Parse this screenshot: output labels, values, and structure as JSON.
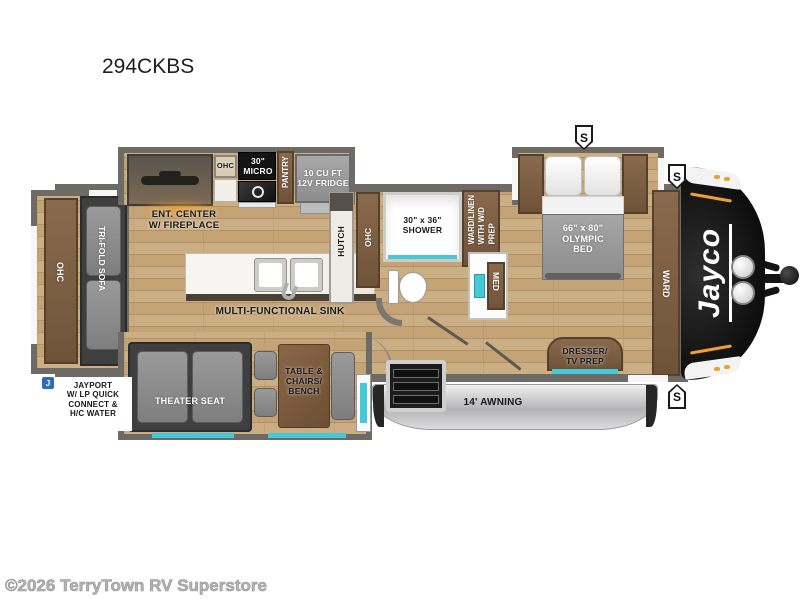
{
  "page": {
    "title": "294CKBS",
    "watermark": "©2026 TerryTown RV Superstore"
  },
  "brand": {
    "logo": "Jayco"
  },
  "icons": {
    "speaker": "S",
    "jayport": "J"
  },
  "rooms": {
    "rear_ohc": "OHC",
    "trifold_sofa": "TRI-FOLD SOFA",
    "ent_center": "ENT. CENTER\nW/ FIREPLACE",
    "kitchen_ohc": "OHC",
    "micro": "30\"\nMICRO",
    "pantry": "PANTRY",
    "fridge": "10 CU FT\n12V FRIDGE",
    "hutch": "HUTCH",
    "hutch_ohc": "OHC",
    "sink": "MULTI-FUNCTIONAL SINK",
    "shower": "30\" x 36\"\nSHOWER",
    "ward_linen": "WARD/LINEN\nWITH W/D\nPREP",
    "med": "MED",
    "bed": "66\" x 80\"\nOLYMPIC\nBED",
    "ward": "WARD",
    "dresser": "DRESSER/\nTV PREP",
    "theater_seat": "THEATER SEAT",
    "dinette": "TABLE &\nCHAIRS/\nBENCH",
    "awning": "14' AWNING",
    "jayport": "JAYPORT\nW/ LP QUICK\nCONNECT &\nH/C WATER"
  },
  "colors": {
    "teal": "#45c8d8",
    "wall": "#6e6b66",
    "wood": "#c9ab81",
    "brown": "#7b5d43",
    "cap": "#131313",
    "awn": "#c6c6c8",
    "glow": "#f0a030",
    "jblue": "#2a6fb8"
  }
}
